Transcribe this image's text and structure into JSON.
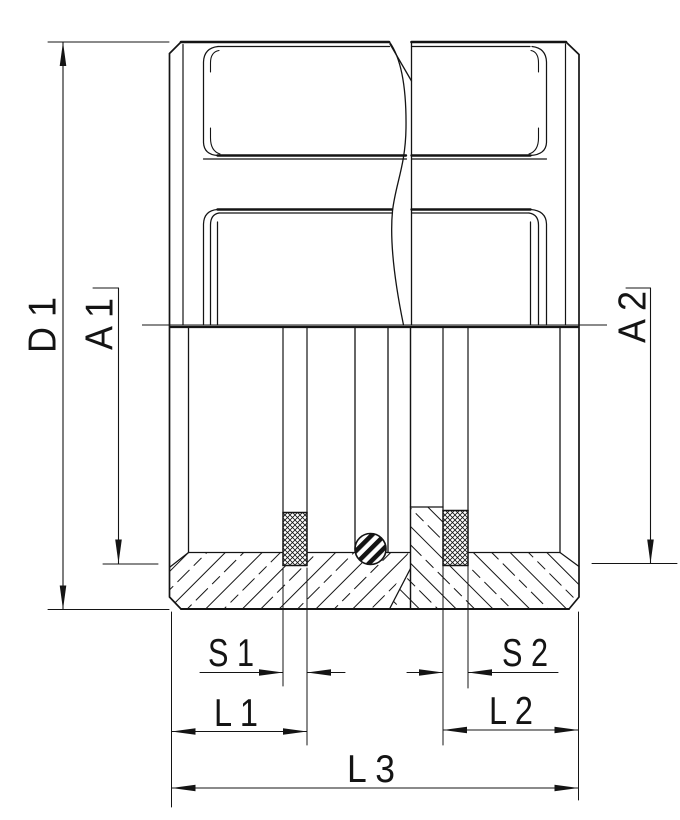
{
  "drawing": {
    "background_color": "#ffffff",
    "line_color": "#141414",
    "dimension_labels": {
      "d1": "D 1",
      "a1": "A 1",
      "a2": "A 2",
      "s1": "S 1",
      "s2": "S 2",
      "l1": "L 1",
      "l2": "L 2",
      "l3": "L 3"
    }
  }
}
